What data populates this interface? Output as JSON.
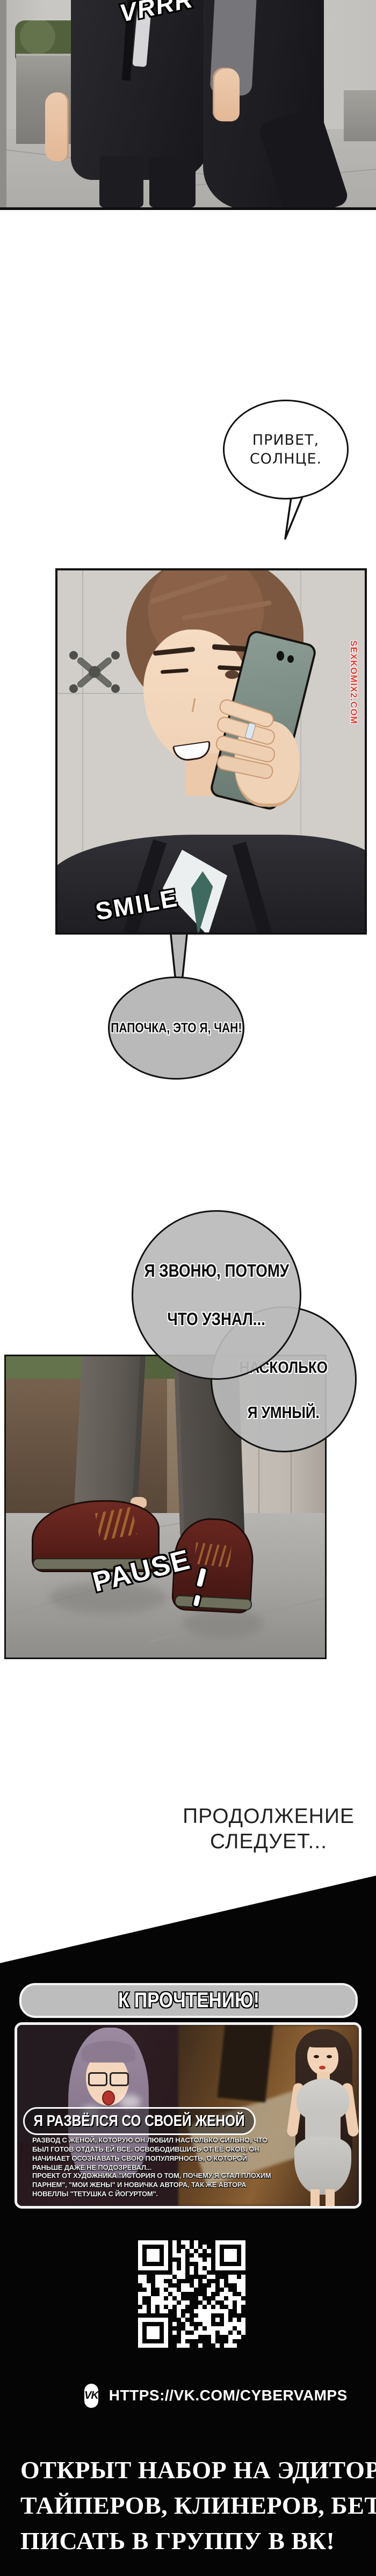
{
  "comic": {
    "sfx": {
      "vrrr": "VRRR",
      "smile": "SMILE",
      "pause": "PAUSE"
    },
    "bubbles": {
      "greeting_line1": "ПРИВЕТ,",
      "greeting_line2": "СОЛНЦЕ.",
      "phone_reply": "ПАПОЧКА, ЭТО Я, ЧАН!",
      "calling_line1": "Я ЗВОНЮ, ПОТОМУ",
      "calling_line2": "ЧТО УЗНАЛ...",
      "smart_line1": "НАСКОЛЬКО",
      "smart_line2": "Я УМНЫЙ."
    },
    "watermark": "SEXKOMIX2.COM",
    "ending_line1": "ПРОДОЛЖЕНИЕ",
    "ending_line2": "СЛЕДУЕТ..."
  },
  "promo": {
    "banner": "К ПРОЧТЕНИЮ!",
    "card": {
      "title": "Я РАЗВЁЛСЯ СО СВОЕЙ ЖЕНОЙ",
      "desc1": "РАЗВОД С ЖЕНОЙ, КОТОРУЮ ОН ЛЮБИЛ НАСТОЛЬКО СИЛЬНО, ЧТО БЫЛ ГОТОВ ОТДАТЬ ЕЙ ВСЁ. ОСВОБОДИВШИСЬ ОТ ЕЁ ОКОВ, ОН НАЧИНАЕТ ОСОЗНАВАТЬ СВОЮ ПОПУЛЯРНОСТЬ, О КОТОРОЙ РАНЬШЕ ДАЖЕ НЕ ПОДОЗРЕВАЛ...",
      "desc2": "ПРОЕКТ ОТ ХУДОЖНИКА \"ИСТОРИЯ О ТОМ, ПОЧЕМУ Я СТАЛ ПЛОХИМ ПАРНЕМ\", \"МОИ ЖЕНЫ\" И НОВИЧКА АВТОРА, ТАК ЖЕ АВТОРА НОВЕЛЛЫ \"ТЕТУШКА С ЙОГУРТОМ\"."
    },
    "vk": {
      "icon_label": "VK",
      "url": "HTTPS://VK.COM/CYBERVAMPS"
    },
    "recruit_line1": "ОТКРЫТ НАБОР НА ЭДИТОРОВ,",
    "recruit_line2": "ТАЙПЕРОВ, КЛИНЕРОВ, БЕТЫ.",
    "recruit_line3": "ПИСАТЬ В ГРУППУ В ВК!"
  },
  "colors": {
    "watermark_red": "#e8372c",
    "bubble_gray": "#b9b9b9",
    "banner_gray": "#bdbdbd",
    "black_bg": "#050505",
    "shoe_maroon": "#5c201b"
  }
}
